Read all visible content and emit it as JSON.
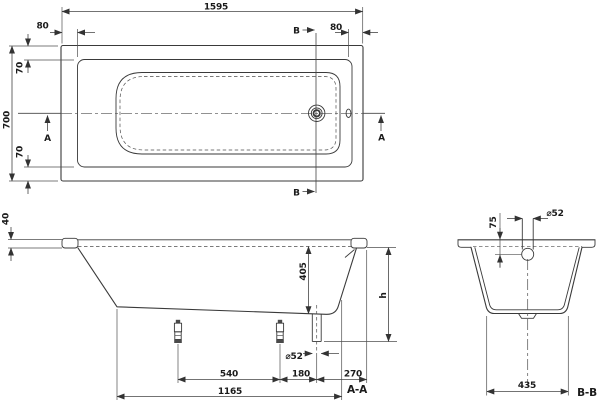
{
  "drawing": {
    "colors": {
      "background": "#ffffff",
      "tub_fill": "#eaeaea",
      "basin_fill": "#f1f1f1",
      "line": "#3a3a3a",
      "dim": "#454545",
      "text": "#1b1b1b"
    },
    "top_view": {
      "length": "1595",
      "rim_end_left": "80",
      "rim_end_right": "80",
      "width": "700",
      "rim_side_top": "70",
      "rim_side_bottom": "70",
      "section_a": "A",
      "section_b": "B"
    },
    "section_aa": {
      "label": "A-A",
      "rim_height": "40",
      "inner_depth": "405",
      "overall_height": "h",
      "drain_diameter": "⌀52",
      "foot_spacing": "540",
      "foot_to_drain": "180",
      "drain_to_end": "270",
      "flat_bottom_length": "1165"
    },
    "section_bb": {
      "label": "B-B",
      "drain_diameter": "⌀52",
      "rim_to_drain_depth": "75",
      "bottom_width": "435"
    }
  }
}
